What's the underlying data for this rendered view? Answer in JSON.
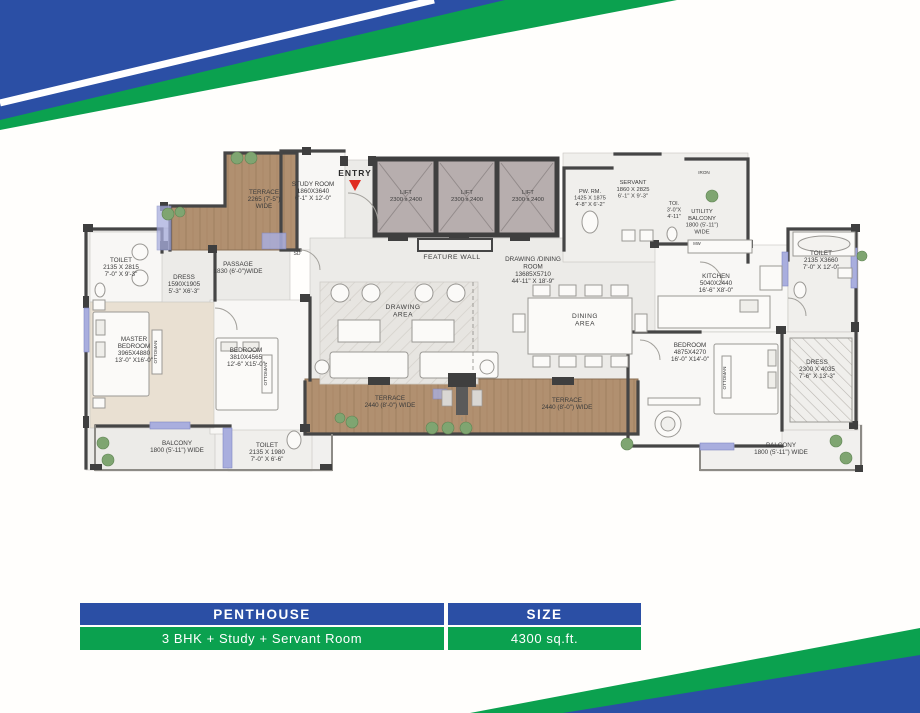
{
  "colors": {
    "blue": "#2b4fa5",
    "green": "#0ba14f",
    "wall": "#454545",
    "wood": "#b19070",
    "wood_dark": "#9d7c5c",
    "floor": "#ecebe8",
    "room": "#f8f7f5",
    "master_floor": "#e9e0d2",
    "window": "#a9aede",
    "entry_red": "#e02b20",
    "label": "#3b3b3b",
    "plant": "#7fa571"
  },
  "entry_label": "ENTRY",
  "plan": {
    "rooms": [
      {
        "id": "terrace-top",
        "lines": [
          "TERRACE",
          "2265 (7'-5\")",
          "WIDE"
        ]
      },
      {
        "id": "study-room",
        "lines": [
          "STUDY ROOM",
          "1860X3640",
          "6'-1\" X 12'-0\""
        ]
      },
      {
        "id": "lift-1",
        "lines": [
          "LIFT",
          "2300 x 2400"
        ]
      },
      {
        "id": "lift-2",
        "lines": [
          "LIFT",
          "2300 x 2400"
        ]
      },
      {
        "id": "lift-3",
        "lines": [
          "LIFT",
          "2300 x 2400"
        ]
      },
      {
        "id": "pw-rm",
        "lines": [
          "PW. RM.",
          "1425 X 1875",
          "4'-8\" X 6'-2\""
        ]
      },
      {
        "id": "servant",
        "lines": [
          "SERVANT",
          "1860 X 2825",
          "6'-1\" X 9'-3\""
        ]
      },
      {
        "id": "toi",
        "lines": [
          "TOI.",
          "3'-0\"X",
          "4'-11\""
        ]
      },
      {
        "id": "iron",
        "lines": [
          "IRON"
        ]
      },
      {
        "id": "utility-balcony",
        "lines": [
          "UTILITY",
          "BALCONY",
          "1800 (5'-11\")",
          "WIDE"
        ]
      },
      {
        "id": "mw",
        "lines": [
          "MW"
        ]
      },
      {
        "id": "feature-wall",
        "lines": [
          "FEATURE WALL"
        ]
      },
      {
        "id": "drawing-dining-room",
        "lines": [
          "DRAWING /DINING",
          "ROOM",
          "13685X5710",
          "44'-11\" X 18'-9\""
        ]
      },
      {
        "id": "drawing-area",
        "lines": [
          "DRAWING",
          "AREA"
        ]
      },
      {
        "id": "dining-area",
        "lines": [
          "DINING",
          "AREA"
        ]
      },
      {
        "id": "kitchen",
        "lines": [
          "KITCHEN",
          "5040X2440",
          "16'-6\" X8'-0\""
        ]
      },
      {
        "id": "toilet-right",
        "lines": [
          "TOILET",
          "2135 X3660",
          "7'-0\" X 12'-0\""
        ]
      },
      {
        "id": "toilet-left",
        "lines": [
          "TOILET",
          "2135 X 2815",
          "7'-0\" X 9'-3\""
        ]
      },
      {
        "id": "dress-left",
        "lines": [
          "DRESS",
          "1590X1905",
          "5'-3\" X6'-3\""
        ]
      },
      {
        "id": "passage",
        "lines": [
          "PASSAGE",
          "1830 (6'-0\")WIDE"
        ]
      },
      {
        "id": "master-bedroom",
        "lines": [
          "MASTER",
          "BEDROOM",
          "3965X4880",
          "13'-0\" X16'-0\""
        ]
      },
      {
        "id": "bedroom-left",
        "lines": [
          "BEDROOM",
          "3810X4565",
          "12'-6\" X15'-0\""
        ]
      },
      {
        "id": "toilet-bottom",
        "lines": [
          "TOILET",
          "2135 X 1980",
          "7'-0\" X 6'-6\""
        ]
      },
      {
        "id": "balcony-left",
        "lines": [
          "BALCONY",
          "1800 (5'-11\") WIDE"
        ]
      },
      {
        "id": "terrace-bottom-left",
        "lines": [
          "TERRACE",
          "2440 (8'-0\") WIDE"
        ]
      },
      {
        "id": "terrace-bottom-right",
        "lines": [
          "TERRACE",
          "2440 (8'-0\") WIDE"
        ]
      },
      {
        "id": "bedroom-right",
        "lines": [
          "BEDROOM",
          "4875X4270",
          "16'-0\" X14'-0\""
        ]
      },
      {
        "id": "dress-right",
        "lines": [
          "DRESS",
          "2300 X 4035",
          "7'-6\" X 13'-3\""
        ]
      },
      {
        "id": "balcony-right",
        "lines": [
          "BALCONY",
          "1800 (5'-11\") WIDE"
        ]
      },
      {
        "id": "sd",
        "lines": [
          "SD"
        ]
      },
      {
        "id": "ottoman-left",
        "lines": [
          "OTTOMAN"
        ]
      },
      {
        "id": "ottoman-mid",
        "lines": [
          "OTTOMAN"
        ]
      },
      {
        "id": "ottoman-right",
        "lines": [
          "OTTOMAN"
        ]
      }
    ]
  },
  "spec_table": {
    "header": {
      "col1": "PENTHOUSE",
      "col2": "SIZE"
    },
    "row": {
      "col1": "3 BHK + Study + Servant Room",
      "col2": "4300 sq.ft."
    }
  }
}
